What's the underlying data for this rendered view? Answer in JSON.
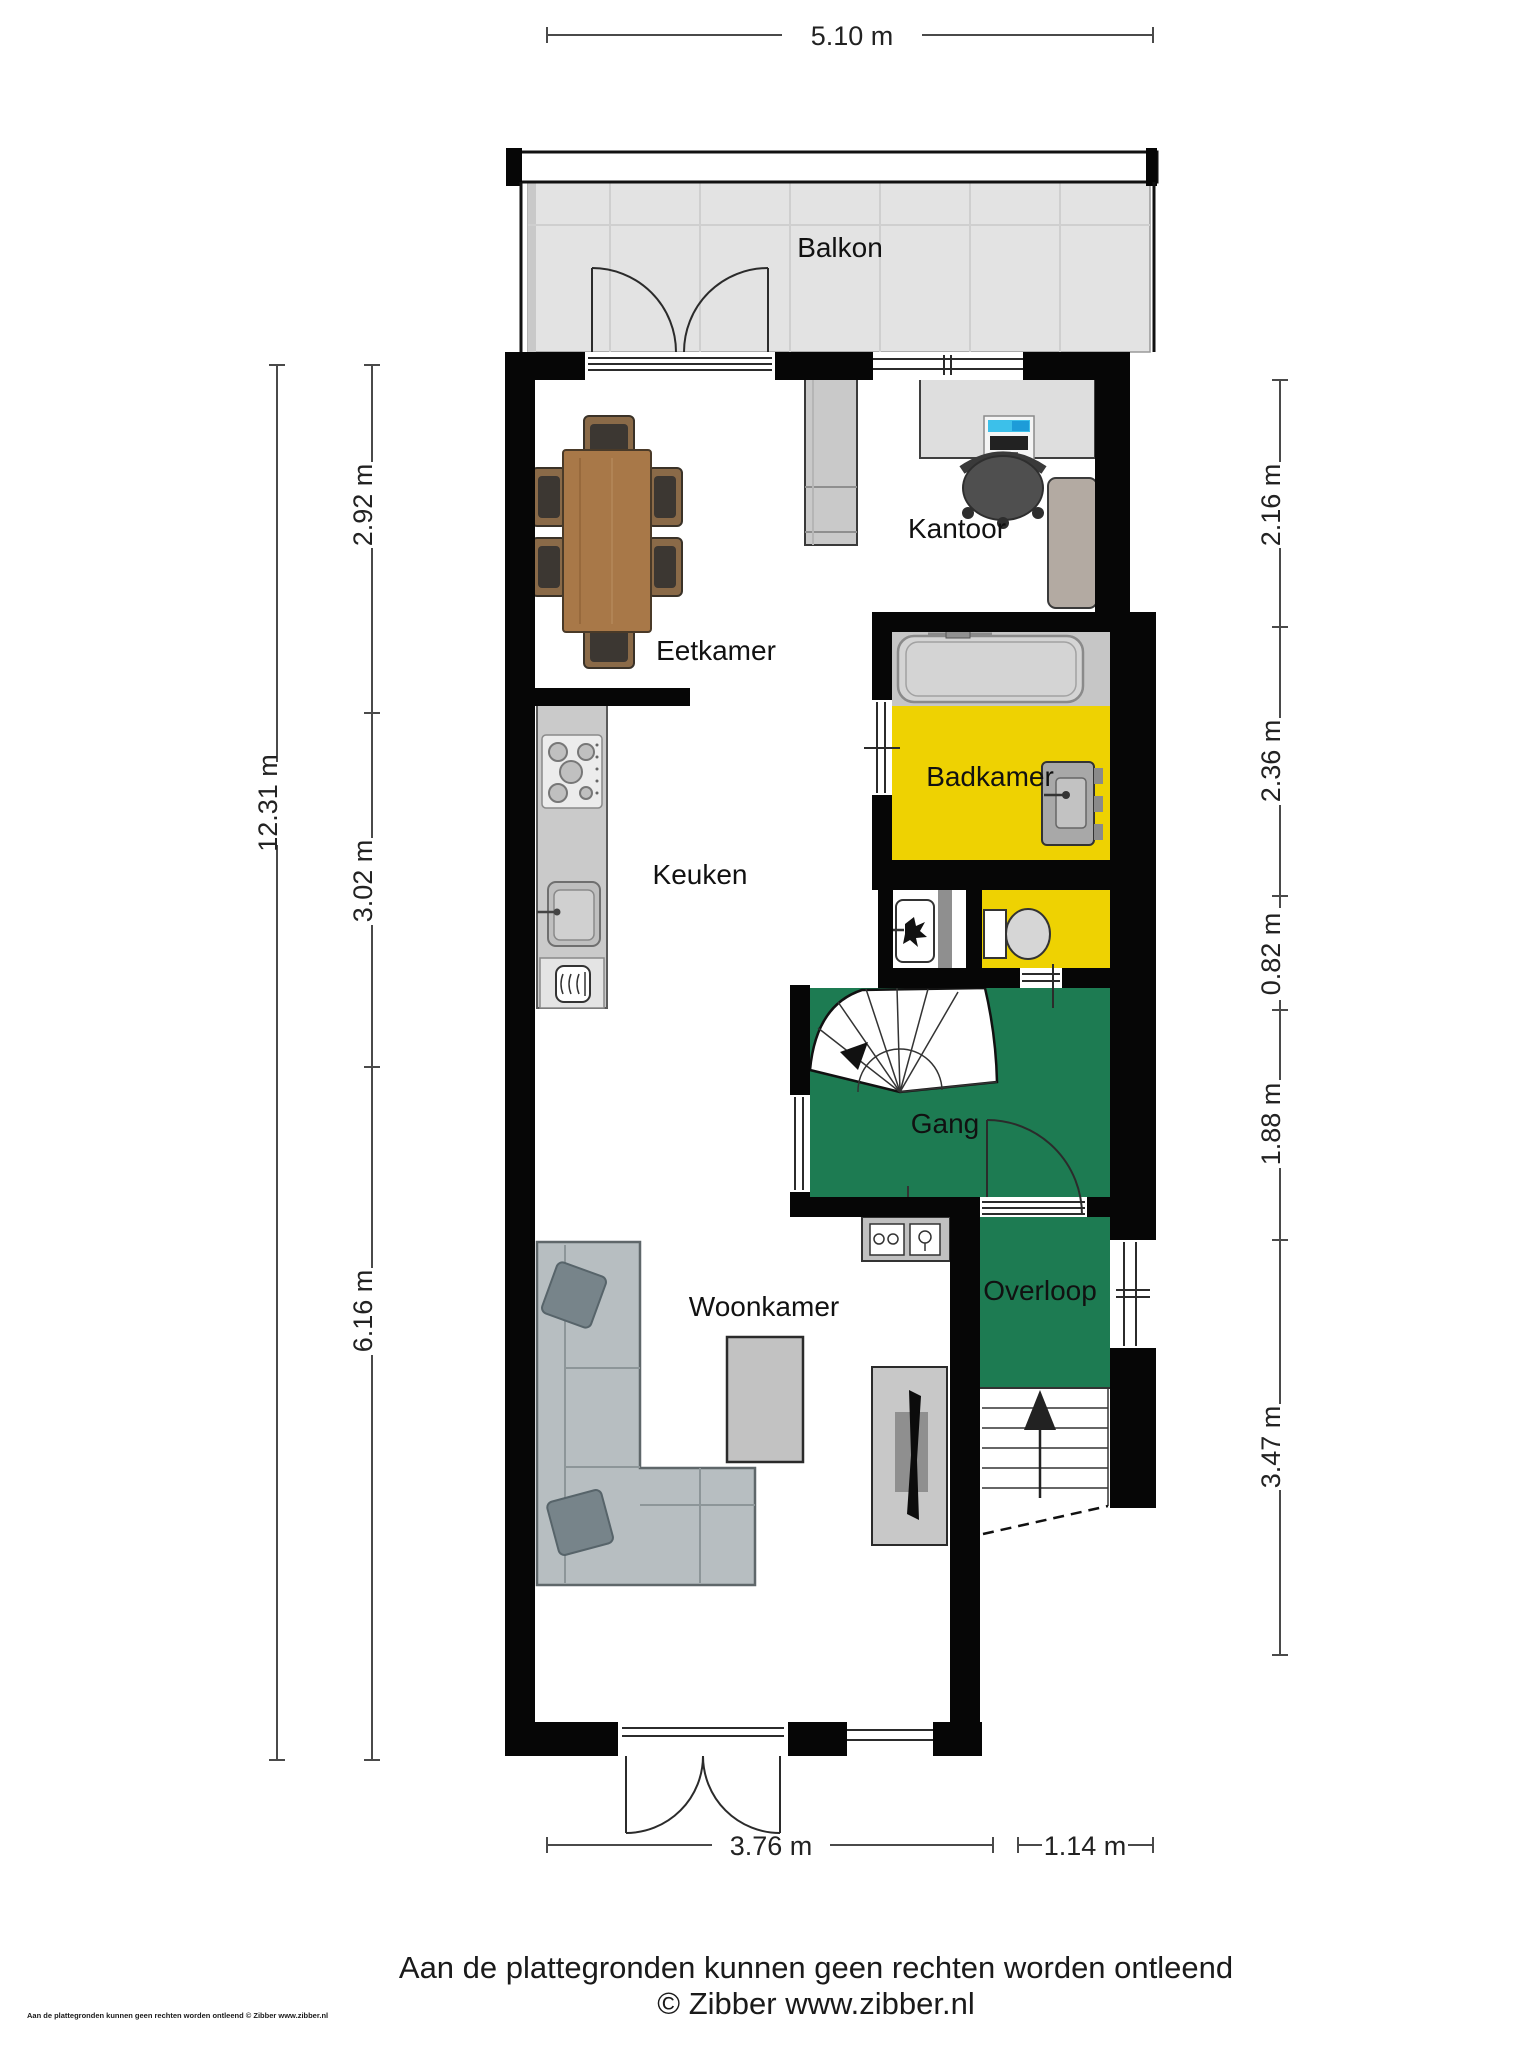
{
  "rooms": {
    "balkon": "Balkon",
    "kantoor": "Kantoor",
    "eetkamer": "Eetkamer",
    "badkamer": "Badkamer",
    "keuken": "Keuken",
    "gang": "Gang",
    "woonkamer": "Woonkamer",
    "overloop": "Overloop"
  },
  "dimensions": {
    "top": "5.10 m",
    "left_total": "12.31 m",
    "left_segments": [
      "2.92 m",
      "3.02 m",
      "6.16 m"
    ],
    "right_segments": [
      "2.16 m",
      "2.36 m",
      "0.82 m",
      "1.88 m",
      "3.47 m"
    ],
    "bottom_segments": [
      "3.76 m",
      "1.14 m"
    ]
  },
  "footer": {
    "disclaimer": "Aan de plattegronden kunnen geen rechten worden ontleend",
    "credit": "© Zibber www.zibber.nl",
    "corner_note": "Aan de plattegronden kunnen geen rechten worden ontleend © Zibber www.zibber.nl"
  },
  "colors": {
    "wall": "#060606",
    "hallway_green": "#1d7b52",
    "bathroom_yellow": "#eed202",
    "balcony_gray": "#e3e3e3",
    "dimension_text": "#222222"
  }
}
